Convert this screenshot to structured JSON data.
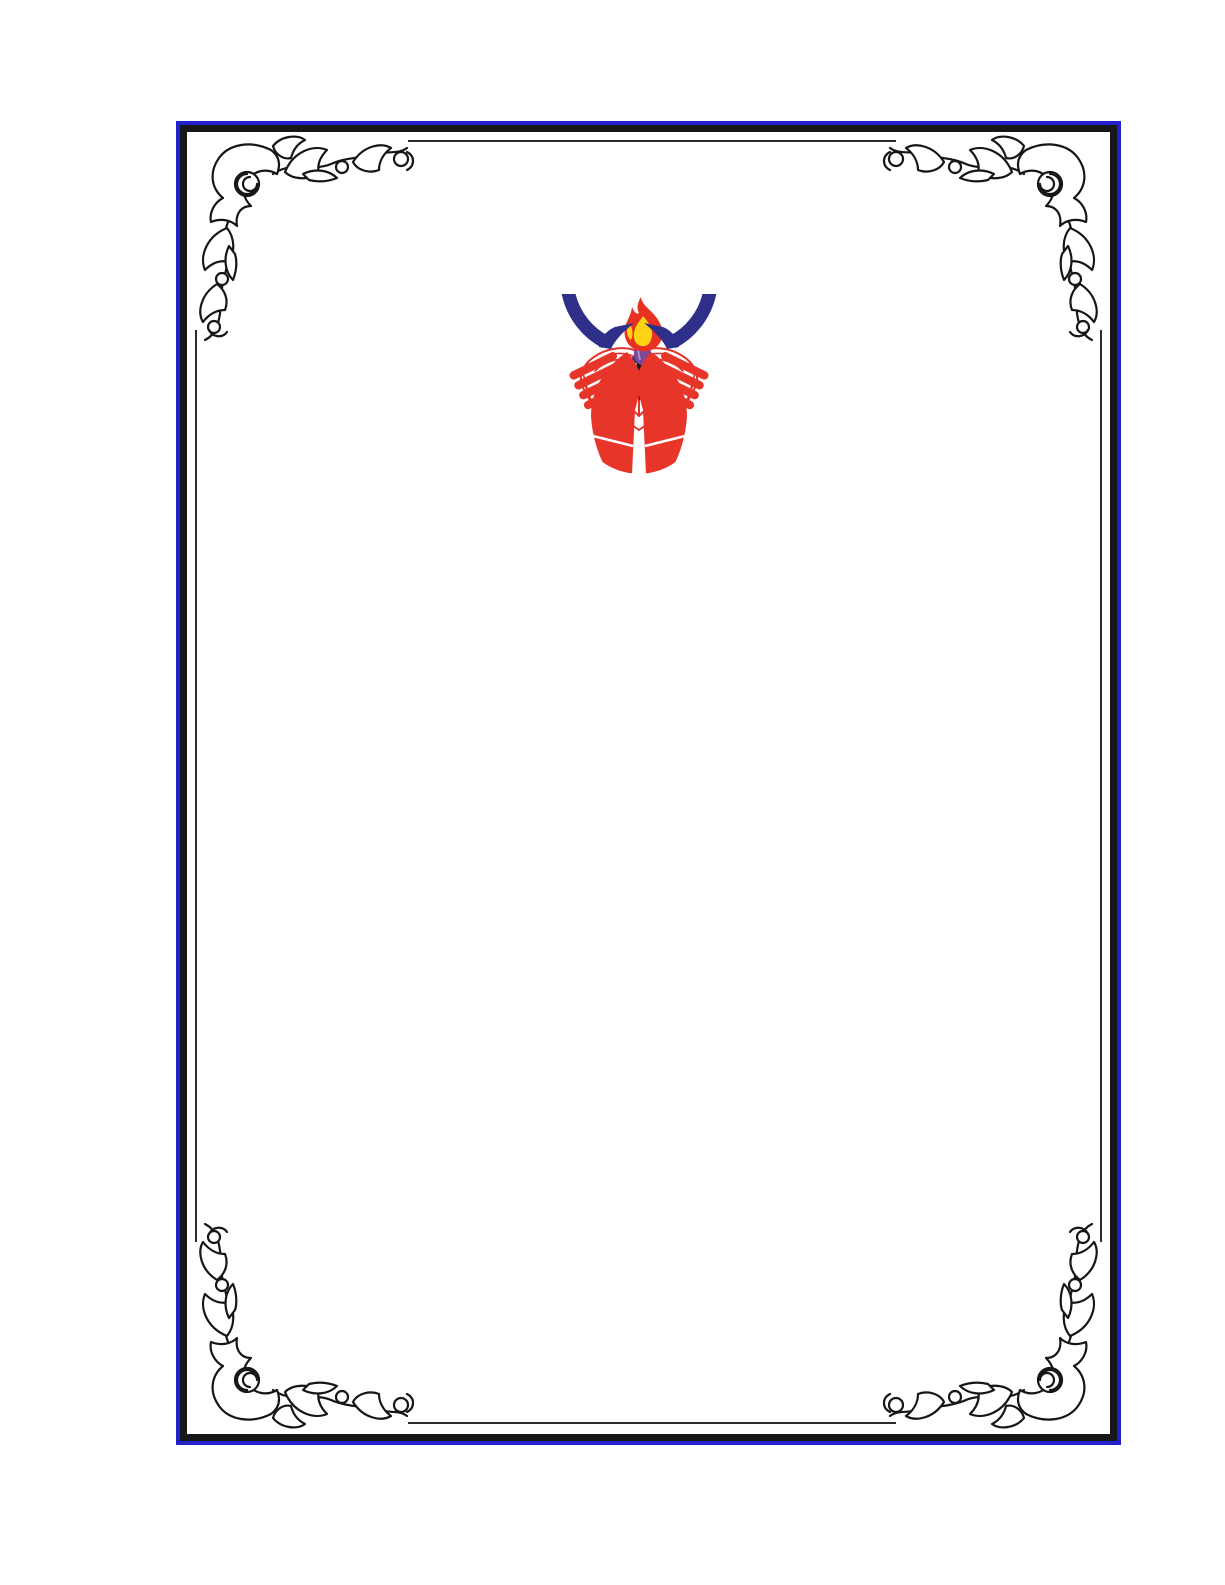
{
  "page": {
    "background_color": "#ffffff",
    "kind": "blank bordered document page with university emblem"
  },
  "border": {
    "outer_line_color": "#2222cc",
    "band_color": "#17171a",
    "inner_line_color": "#2b2b2b",
    "ornament_color": "#161616",
    "ornament_fill": "#ffffff"
  },
  "emblem": {
    "name": "university-emblem",
    "ring_color": "#2d2f88",
    "hands_color": "#e8352a",
    "book_fill_color": "#ffffff",
    "book_outline_color": "#e5332a",
    "gear_color": "#2d2f88",
    "torch_color": "#1b1b1b",
    "torch_flame_color": "#7c4898",
    "torch_flame_highlight": "#b28cc6",
    "flame_outer_color": "#e93122",
    "flame_inner_color": "#ffd414",
    "separator_color": "#ffffff"
  }
}
